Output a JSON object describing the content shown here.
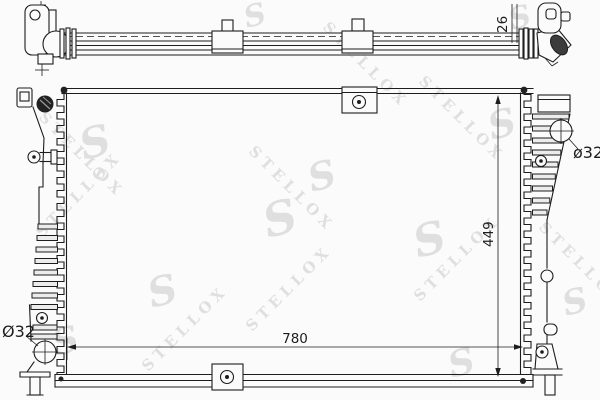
{
  "watermark": {
    "brand_text": "STELLOX",
    "logo_glyph": "S"
  },
  "dimensions": {
    "top_view_depth": {
      "value": "26",
      "orientation": "vertical"
    },
    "front_height": {
      "value": "449",
      "orientation": "vertical"
    },
    "front_width": {
      "value": "780",
      "orientation": "horizontal"
    },
    "left_port": {
      "value": "Ø32"
    },
    "right_port": {
      "value": "ø32"
    }
  },
  "colors": {
    "background": "#fbfbfb",
    "line": "#1d1d1d",
    "watermark": "#dcdcdc",
    "filler_cap": "#222222"
  }
}
